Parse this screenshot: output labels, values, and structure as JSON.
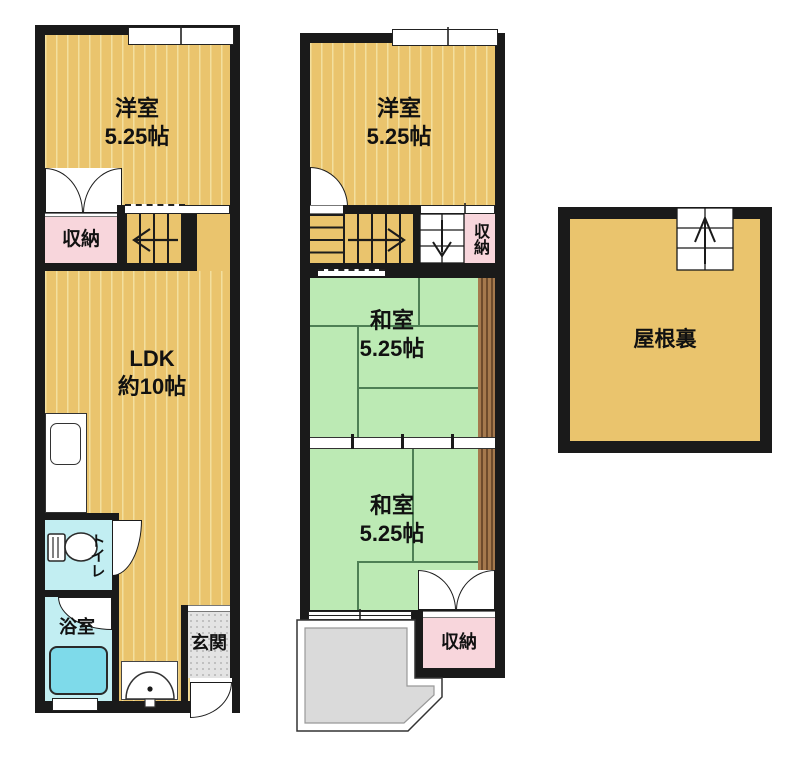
{
  "rooms": {
    "f1_west": {
      "name": "洋室",
      "size": "5.25帖"
    },
    "f1_storage": {
      "name": "収納"
    },
    "f1_ldk": {
      "name": "LDK",
      "size": "約10帖"
    },
    "f1_toilet": {
      "name": "トイレ"
    },
    "f1_bath": {
      "name": "浴室"
    },
    "f1_entrance": {
      "name": "玄関"
    },
    "f2_west": {
      "name": "洋室",
      "size": "5.25帖"
    },
    "f2_storage_top": {
      "name": "収納"
    },
    "f2_japanese_1": {
      "name": "和室",
      "size": "5.25帖"
    },
    "f2_japanese_2": {
      "name": "和室",
      "size": "5.25帖"
    },
    "f2_storage_bottom": {
      "name": "収納"
    },
    "attic": {
      "name": "屋根裏"
    }
  },
  "colors": {
    "wall": "#1a1a1a",
    "flooring": "#eac46d",
    "flooring_stripe": "#f3df9e",
    "tatami": "#bceab4",
    "tatami_line": "#4e8055",
    "storage_pink": "#f8d6dc",
    "wet_room_cyan": "#c2eef2",
    "bathtub": "#7edaea",
    "entrance_gray": "#e3e3e3",
    "balcony_gray": "#dadada",
    "wood_strip": "#a5794d"
  }
}
